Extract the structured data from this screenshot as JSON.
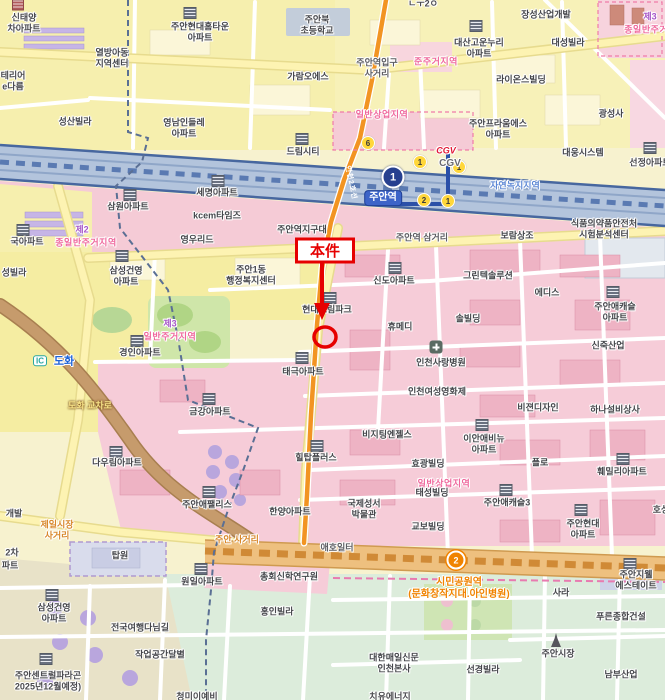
{
  "map": {
    "width": 665,
    "height": 700,
    "kind": "street-map"
  },
  "colors": {
    "annotation_red": "#e60000",
    "line1_navy": "#27408f",
    "line2_orange": "#f29422",
    "rail_band": "#b3c4dc",
    "zone_pink_text": "#ef679c",
    "zone_green_text": "#5b86d4",
    "commercial_pink": "#f6ccd8",
    "residential_yellow": "#f5eda2",
    "green_belt": "#dcecdb"
  },
  "annotation": {
    "label": "本件"
  },
  "labels": [
    {
      "name": "poi-sintaeyang-apt",
      "text": "신태양\n차아파트",
      "x": 24,
      "y": 23,
      "cls": "clip"
    },
    {
      "name": "poi-juan-hyundai-hometown-apt",
      "text": "주안현대홈타운\n아파트",
      "x": 200,
      "y": 32
    },
    {
      "name": "poi-yeolbang-children-center",
      "text": "열방아동\n지역센터",
      "x": 112,
      "y": 58
    },
    {
      "name": "poi-terior-edareum",
      "text": "테리어\ne다름",
      "x": 13,
      "y": 81,
      "cls": "clip"
    },
    {
      "name": "clipped-label-top",
      "text": "ㄴㅜ2ㅇ",
      "x": 423,
      "y": 4,
      "cls": "clip"
    },
    {
      "name": "poi-juanbuk-elementary",
      "text": "주안북\n초등학교",
      "x": 317,
      "y": 25
    },
    {
      "name": "poi-jangseong-industrial",
      "text": "장성산업개발",
      "x": 546,
      "y": 15
    },
    {
      "name": "poi-daesan-gounnuri-apt",
      "text": "대산고운누리\n아파트",
      "x": 479,
      "y": 48
    },
    {
      "name": "poi-daeseong-villa",
      "text": "대성빌라",
      "x": 568,
      "y": 43
    },
    {
      "name": "zone-num-top-right",
      "text": "제3",
      "x": 650,
      "y": 17,
      "cls": "zone-num"
    },
    {
      "name": "zone-jong3-top-right",
      "text": "종일반주거지역",
      "x": 655,
      "y": 30,
      "cls": "zone"
    },
    {
      "name": "road-juanyeok-ipgu-sageori",
      "text": "주안역입구\n사거리",
      "x": 377,
      "y": 68,
      "cls": "roadname"
    },
    {
      "name": "zone-junjugeo",
      "text": "준주거지역",
      "x": 436,
      "y": 62,
      "cls": "zone"
    },
    {
      "name": "poi-garam-oes",
      "text": "가람오에스",
      "x": 308,
      "y": 77
    },
    {
      "name": "poi-lions-building",
      "text": "라이온스빌딩",
      "x": 521,
      "y": 80
    },
    {
      "name": "zone-commercial-top",
      "text": "일반상업지역",
      "x": 382,
      "y": 115,
      "cls": "zone"
    },
    {
      "name": "poi-seongsan-villa",
      "text": "성산빌라",
      "x": 75,
      "y": 122
    },
    {
      "name": "poi-yeongnam-indeulle-apt",
      "text": "영남인들레\n아파트",
      "x": 184,
      "y": 128
    },
    {
      "name": "poi-juan-praum-es-apt",
      "text": "주안프라움에스\n아파트",
      "x": 498,
      "y": 129
    },
    {
      "name": "poi-gwangseongsa",
      "text": "광성사",
      "x": 611,
      "y": 114
    },
    {
      "name": "poi-dream-city",
      "text": "드림시티",
      "x": 303,
      "y": 152
    },
    {
      "name": "logo-cgv",
      "text": "CGV",
      "x": 446,
      "y": 151,
      "cls": "cgv"
    },
    {
      "name": "poi-cgv",
      "text": "CGV",
      "x": 450,
      "y": 164,
      "cls": "cgvg"
    },
    {
      "name": "poi-daewoong-system",
      "text": "대웅시스템",
      "x": 583,
      "y": 153
    },
    {
      "name": "poi-seonjeong-apt",
      "text": "선정아파트",
      "x": 650,
      "y": 163,
      "cls": "clip"
    },
    {
      "name": "line2-name",
      "text": "인천2호선",
      "x": 350,
      "y": 183,
      "cls": "line2",
      "rot": 78
    },
    {
      "name": "station-tag-juan",
      "text": "주안역",
      "x": 383,
      "y": 198,
      "cls": "tag",
      "inter": true
    },
    {
      "name": "zone-natural-green",
      "text": "자연녹지지역",
      "x": 515,
      "y": 186,
      "cls": "zone-blue"
    },
    {
      "name": "poi-semyeong-apt",
      "text": "세명아파트",
      "x": 217,
      "y": 193
    },
    {
      "name": "poi-samwon-apt",
      "text": "삼원아파트",
      "x": 128,
      "y": 207
    },
    {
      "name": "poi-kcem-times",
      "text": "kcem타임즈",
      "x": 217,
      "y": 216
    },
    {
      "name": "zone-num-left",
      "text": "제2",
      "x": 82,
      "y": 230,
      "cls": "zone-num"
    },
    {
      "name": "zone-jong2-left",
      "text": "종일반주거지역",
      "x": 86,
      "y": 243,
      "cls": "zone"
    },
    {
      "name": "poi-guk-apt",
      "text": "국아파트",
      "x": 27,
      "y": 242,
      "cls": "clip"
    },
    {
      "name": "poi-yeongurid",
      "text": "영우리드",
      "x": 197,
      "y": 240
    },
    {
      "name": "poi-juanyeok-jigudae",
      "text": "주안역지구대",
      "x": 302,
      "y": 230
    },
    {
      "name": "poi-fda-test-center",
      "text": "식품의약품안전처\n시험분석센터",
      "x": 604,
      "y": 229
    },
    {
      "name": "poi-boram-sangjo",
      "text": "보람상조",
      "x": 517,
      "y": 236
    },
    {
      "name": "road-juanyeok-samgeori",
      "text": "주안역 삼거리",
      "x": 422,
      "y": 238,
      "cls": "roadname"
    },
    {
      "name": "poi-juan1dong-center",
      "text": "주안1동\n행정복지센터",
      "x": 251,
      "y": 275
    },
    {
      "name": "poi-samsung-gunyoung-apt-1",
      "text": "삼성건영\n아파트",
      "x": 126,
      "y": 276
    },
    {
      "name": "poi-seong-villa",
      "text": "성빌라",
      "x": 14,
      "y": 273,
      "cls": "clip"
    },
    {
      "name": "poi-greentek-solution",
      "text": "그린텍솔루션",
      "x": 488,
      "y": 276
    },
    {
      "name": "poi-sindo-apt",
      "text": "신도아파트",
      "x": 394,
      "y": 281
    },
    {
      "name": "poi-edis",
      "text": "에디스",
      "x": 547,
      "y": 293
    },
    {
      "name": "poi-juan-ecastle-apt",
      "text": "주안애캐슬\n아파트",
      "x": 615,
      "y": 312
    },
    {
      "name": "poi-hyundai-dreampark",
      "text": "현대드림파크",
      "x": 327,
      "y": 310
    },
    {
      "name": "poi-sol-building",
      "text": "솔빌딩",
      "x": 468,
      "y": 319
    },
    {
      "name": "poi-humedi",
      "text": "휴메디",
      "x": 400,
      "y": 327
    },
    {
      "name": "zone-num-mid-left",
      "text": "제3",
      "x": 170,
      "y": 324,
      "cls": "zone-num"
    },
    {
      "name": "zone-residential-mid-left",
      "text": "일반주거지역",
      "x": 170,
      "y": 337,
      "cls": "zone"
    },
    {
      "name": "poi-sinjuk-industrial",
      "text": "신죽산업",
      "x": 608,
      "y": 346
    },
    {
      "name": "poi-incheon-sarang-hospital",
      "text": "인천사랑병원",
      "x": 441,
      "y": 363
    },
    {
      "name": "poi-gyeongin-apt",
      "text": "경인아파트",
      "x": 140,
      "y": 353
    },
    {
      "name": "badge-ic-dohwa",
      "text": "IC",
      "x": 40,
      "y": 361,
      "cls": "ic"
    },
    {
      "name": "road-dohwa",
      "text": "도화",
      "x": 64,
      "y": 362,
      "cls": "road-blue"
    },
    {
      "name": "poi-taegeuk-apt",
      "text": "태극아파트",
      "x": 303,
      "y": 372
    },
    {
      "name": "poi-incheon-women-film",
      "text": "인천여성영화제",
      "x": 437,
      "y": 392
    },
    {
      "name": "poi-vision-design",
      "text": "비젼디자인",
      "x": 538,
      "y": 408
    },
    {
      "name": "poi-hana-facility",
      "text": "하나설비상사",
      "x": 615,
      "y": 410
    },
    {
      "name": "road-dohwa-gyocharo",
      "text": "도화 교차로",
      "x": 90,
      "y": 406,
      "cls": "road-brown"
    },
    {
      "name": "poi-geumgang-apt",
      "text": "금강아파트",
      "x": 210,
      "y": 412
    },
    {
      "name": "poi-visiting-angels",
      "text": "비지팅엔젤스",
      "x": 387,
      "y": 435
    },
    {
      "name": "poi-ian-avenue-apt",
      "text": "이안애비뉴\n아파트",
      "x": 484,
      "y": 444
    },
    {
      "name": "poi-daurim-apt",
      "text": "다우림아파트",
      "x": 117,
      "y": 463
    },
    {
      "name": "poi-hilltop-plus",
      "text": "힐탑플러스",
      "x": 316,
      "y": 458
    },
    {
      "name": "poi-hyogwang-building",
      "text": "효광빌딩",
      "x": 428,
      "y": 464
    },
    {
      "name": "poi-flo",
      "text": "플로",
      "x": 540,
      "y": 463
    },
    {
      "name": "poi-family-apt",
      "text": "훼밀리아파트",
      "x": 622,
      "y": 472
    },
    {
      "name": "zone-commercial-mid",
      "text": "일반상업지역",
      "x": 444,
      "y": 484,
      "cls": "zone"
    },
    {
      "name": "poi-taeseong-building",
      "text": "태성빌딩",
      "x": 432,
      "y": 493
    },
    {
      "name": "poi-juan-aepallis",
      "text": "주안애팰리스",
      "x": 207,
      "y": 505
    },
    {
      "name": "poi-hanyang-apt",
      "text": "한양아파트",
      "x": 290,
      "y": 512
    },
    {
      "name": "poi-bible-museum",
      "text": "국제성서\n박물관",
      "x": 364,
      "y": 509
    },
    {
      "name": "poi-juan-ecastle3",
      "text": "주안애캐슬3",
      "x": 507,
      "y": 503
    },
    {
      "name": "poi-kyobo-building",
      "text": "교보빌딩",
      "x": 428,
      "y": 527
    },
    {
      "name": "poi-hoseong",
      "text": "호성",
      "x": 661,
      "y": 510,
      "cls": "clip"
    },
    {
      "name": "poi-juan-hyundai-apt",
      "text": "주안현대\n아파트",
      "x": 583,
      "y": 529
    },
    {
      "name": "poi-gaebal",
      "text": "개발",
      "x": 14,
      "y": 514,
      "cls": "clip"
    },
    {
      "name": "road-jeil-market-sageori",
      "text": "제일시장\n사거리",
      "x": 57,
      "y": 530,
      "cls": "roadname-o"
    },
    {
      "name": "road-juan-sageori",
      "text": "주안 사거리",
      "x": 237,
      "y": 540,
      "cls": "roadname-o"
    },
    {
      "name": "poi-2cha",
      "text": "2차",
      "x": 12,
      "y": 553,
      "cls": "clip"
    },
    {
      "name": "poi-pateu",
      "text": "파트",
      "x": 10,
      "y": 566,
      "cls": "clip"
    },
    {
      "name": "poi-topwon",
      "text": "탑원",
      "x": 120,
      "y": 556
    },
    {
      "name": "road-aeho-ilteo",
      "text": "애호일터",
      "x": 337,
      "y": 548,
      "cls": "roadname"
    },
    {
      "name": "poi-wonil-apt",
      "text": "원일아파트",
      "x": 202,
      "y": 582
    },
    {
      "name": "poi-chonghoe-seminary",
      "text": "총회신학연구원",
      "x": 289,
      "y": 577
    },
    {
      "name": "station-simin-park-name",
      "text": "시민공원역\n(문화창작지대.아인병원)",
      "x": 459,
      "y": 589,
      "cls": "station-o",
      "inter": true
    },
    {
      "name": "poi-sara",
      "text": "사라",
      "x": 561,
      "y": 593
    },
    {
      "name": "poi-juan-gwel-estate",
      "text": "주안지웰\n에스테이트",
      "x": 636,
      "y": 580
    },
    {
      "name": "poi-pureun-construction",
      "text": "푸른종합건설",
      "x": 621,
      "y": 617
    },
    {
      "name": "poi-hongin-villa",
      "text": "홍인빌라",
      "x": 277,
      "y": 612
    },
    {
      "name": "poi-samsung-gunyoung-apt-2",
      "text": "삼성건영\n아파트",
      "x": 54,
      "y": 613
    },
    {
      "name": "poi-travel-trail",
      "text": "전국여행다님길",
      "x": 140,
      "y": 628
    },
    {
      "name": "poi-workspace-dalbyeol",
      "text": "작업공간달별",
      "x": 160,
      "y": 655
    },
    {
      "name": "poi-juan-central-paragon",
      "text": "주안센트럴파라곤\n2025년12월예정)",
      "x": 48,
      "y": 681,
      "cls": "clip"
    },
    {
      "name": "poi-daehan-maeil-incheon",
      "text": "대한매일신문\n인천본사",
      "x": 394,
      "y": 663
    },
    {
      "name": "poi-seonkyeong-villa",
      "text": "선경빌라",
      "x": 483,
      "y": 670
    },
    {
      "name": "poi-juan-market",
      "text": "주안시장",
      "x": 558,
      "y": 654
    },
    {
      "name": "poi-nambu-industrial",
      "text": "남부산업",
      "x": 621,
      "y": 675
    },
    {
      "name": "clipped-label-bottom-1",
      "text": "청미이예비",
      "x": 197,
      "y": 697,
      "cls": "clip"
    },
    {
      "name": "clipped-label-bottom-2",
      "text": "치유에너지",
      "x": 390,
      "y": 697,
      "cls": "clip"
    }
  ],
  "badges": [
    {
      "name": "line1-station-badge",
      "text": "1",
      "x": 393,
      "y": 177,
      "cls": "r1",
      "inter": true
    },
    {
      "name": "line2-station-badge",
      "text": "2",
      "x": 456,
      "y": 560,
      "cls": "r2",
      "inter": true
    },
    {
      "name": "exit-badge-6",
      "text": "6",
      "x": 368,
      "y": 143,
      "cls": "exit"
    },
    {
      "name": "exit-badge-1a",
      "text": "1",
      "x": 420,
      "y": 162,
      "cls": "exit"
    },
    {
      "name": "exit-badge-1b",
      "text": "1",
      "x": 459,
      "y": 167,
      "cls": "exit"
    },
    {
      "name": "exit-badge-2",
      "text": "2",
      "x": 424,
      "y": 200,
      "cls": "exit"
    },
    {
      "name": "exit-badge-1c",
      "text": "1",
      "x": 448,
      "y": 201,
      "cls": "exit"
    }
  ],
  "icons": [
    {
      "name": "building-icon",
      "x": 18,
      "y": 5,
      "cls": "bld-red"
    },
    {
      "name": "building-icon",
      "x": 190,
      "y": 13,
      "cls": "bld"
    },
    {
      "name": "building-icon",
      "x": 476,
      "y": 26,
      "cls": "bld"
    },
    {
      "name": "building-icon",
      "x": 302,
      "y": 139,
      "cls": "bld"
    },
    {
      "name": "building-icon",
      "x": 650,
      "y": 148,
      "cls": "bld"
    },
    {
      "name": "building-icon",
      "x": 218,
      "y": 181,
      "cls": "bld"
    },
    {
      "name": "building-icon",
      "x": 130,
      "y": 195,
      "cls": "bld"
    },
    {
      "name": "building-icon",
      "x": 23,
      "y": 230,
      "cls": "bld"
    },
    {
      "name": "building-icon",
      "x": 122,
      "y": 256,
      "cls": "bld"
    },
    {
      "name": "building-icon",
      "x": 395,
      "y": 268,
      "cls": "bld"
    },
    {
      "name": "building-icon",
      "x": 330,
      "y": 298,
      "cls": "bld"
    },
    {
      "name": "building-icon",
      "x": 613,
      "y": 292,
      "cls": "bld"
    },
    {
      "name": "hospital-icon",
      "x": 436,
      "y": 347,
      "cls": "hosp"
    },
    {
      "name": "building-icon",
      "x": 137,
      "y": 341,
      "cls": "bld"
    },
    {
      "name": "building-icon",
      "x": 302,
      "y": 358,
      "cls": "bld"
    },
    {
      "name": "building-icon",
      "x": 209,
      "y": 399,
      "cls": "bld"
    },
    {
      "name": "building-icon",
      "x": 116,
      "y": 452,
      "cls": "bld"
    },
    {
      "name": "building-icon",
      "x": 317,
      "y": 446,
      "cls": "bld"
    },
    {
      "name": "building-icon",
      "x": 482,
      "y": 425,
      "cls": "bld"
    },
    {
      "name": "building-icon",
      "x": 623,
      "y": 459,
      "cls": "bld"
    },
    {
      "name": "building-icon",
      "x": 209,
      "y": 492,
      "cls": "bld"
    },
    {
      "name": "building-icon",
      "x": 506,
      "y": 490,
      "cls": "bld"
    },
    {
      "name": "building-icon",
      "x": 581,
      "y": 510,
      "cls": "bld"
    },
    {
      "name": "building-icon",
      "x": 201,
      "y": 569,
      "cls": "bld"
    },
    {
      "name": "building-icon",
      "x": 630,
      "y": 564,
      "cls": "bld"
    },
    {
      "name": "building-icon",
      "x": 52,
      "y": 595,
      "cls": "bld"
    },
    {
      "name": "building-icon",
      "x": 46,
      "y": 659,
      "cls": "bld"
    },
    {
      "name": "market-tower-icon",
      "x": 556,
      "y": 640,
      "cls": "twr"
    }
  ]
}
